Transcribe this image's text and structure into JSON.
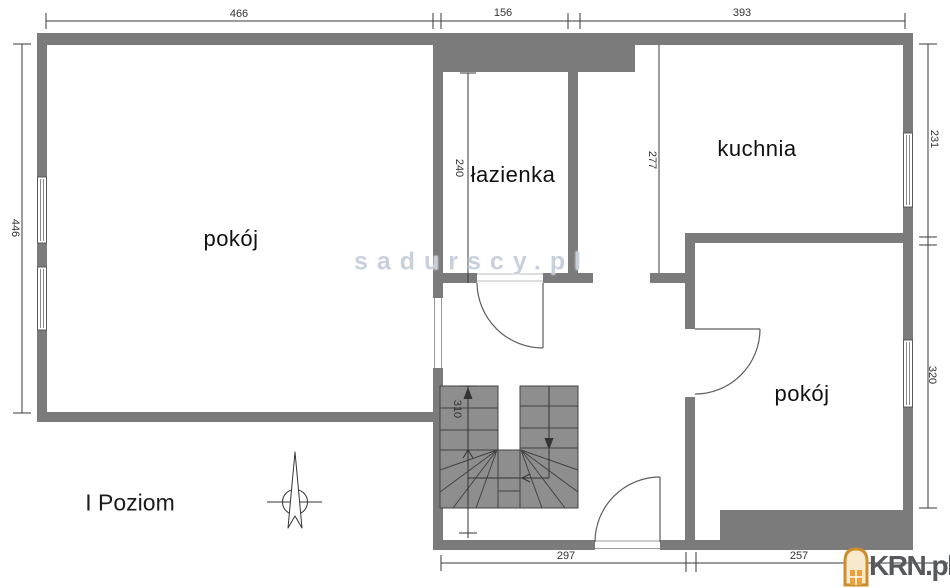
{
  "page": {
    "level_label": "I Poziom",
    "watermark": "sadurscy.pl",
    "brand": {
      "name": "KRN.pl"
    }
  },
  "rooms": [
    {
      "id": "room-1",
      "label": "pokój"
    },
    {
      "id": "bathroom",
      "label": "łazienka"
    },
    {
      "id": "kitchen",
      "label": "kuchnia"
    },
    {
      "id": "room-2",
      "label": "pokój"
    }
  ],
  "dimensions_cm": {
    "top": [
      {
        "value": "466"
      },
      {
        "value": "156"
      },
      {
        "value": "393"
      }
    ],
    "left": [
      {
        "value": "446"
      }
    ],
    "right": [
      {
        "value": "231"
      },
      {
        "value": "320"
      }
    ],
    "bottom": [
      {
        "value": "297"
      },
      {
        "value": "257"
      }
    ],
    "interior": [
      {
        "value": "240"
      },
      {
        "value": "277"
      },
      {
        "value": "310"
      }
    ]
  },
  "icons": {
    "compass": "north-arrow-compass",
    "brand_icon": "krn-house-lantern",
    "stairs": "winder-staircase-up"
  },
  "colors": {
    "wall": "#7b7b7b",
    "stairs_fill": "#8e8e8e",
    "line": "#3a3a3a",
    "watermark": "#c5cedb",
    "brand_text": "#57585b",
    "brand_icon": "#cd8d2d"
  }
}
